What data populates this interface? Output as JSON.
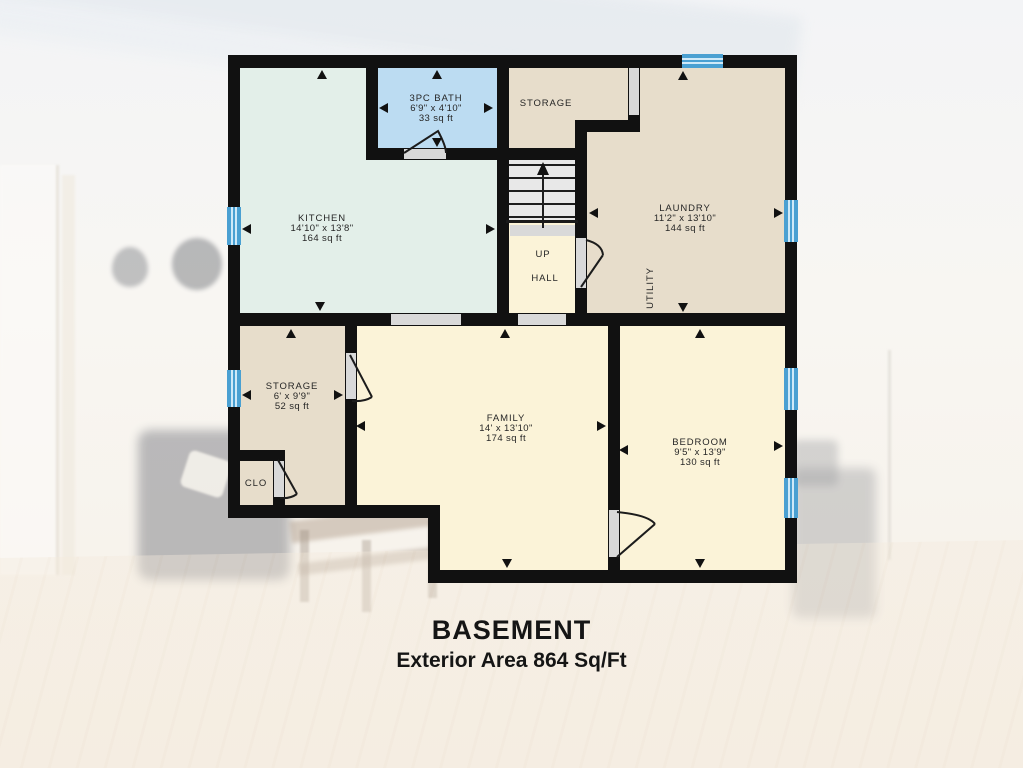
{
  "title": {
    "main": "BASEMENT",
    "sub": "Exterior Area 864 Sq/Ft"
  },
  "rooms": {
    "kitchen": {
      "name": "KITCHEN",
      "dims": "14'10\" x 13'8\"",
      "area": "164 sq ft"
    },
    "bath": {
      "name": "3PC BATH",
      "dims": "6'9\" x 4'10\"",
      "area": "33 sq ft"
    },
    "storage_top": {
      "name": "STORAGE"
    },
    "laundry": {
      "name": "LAUNDRY",
      "dims": "11'2\" x 13'10\"",
      "area": "144 sq ft"
    },
    "utility": {
      "name": "UTILITY"
    },
    "stair_hall": {
      "up": "UP",
      "hall": "HALL"
    },
    "storage_left": {
      "name": "STORAGE",
      "dims": "6' x 9'9\"",
      "area": "52 sq ft"
    },
    "closet": {
      "name": "CLO"
    },
    "family": {
      "name": "FAMILY",
      "dims": "14' x 13'10\"",
      "area": "174 sq ft"
    },
    "bedroom": {
      "name": "BEDROOM",
      "dims": "9'5\" x 13'9\"",
      "area": "130 sq ft"
    }
  },
  "colors": {
    "wall": "#111111",
    "kitchen": "#e3efe9",
    "bath": "#bcdcf2",
    "tan": "#e7ddcb",
    "cream": "#fbf3d8",
    "stairs": "#e8e8e8",
    "door_opening": "#d9d9d9",
    "window_blue": "#4aa0d2",
    "window_stripe": "#cfe9f8",
    "label_text": "#262626"
  }
}
